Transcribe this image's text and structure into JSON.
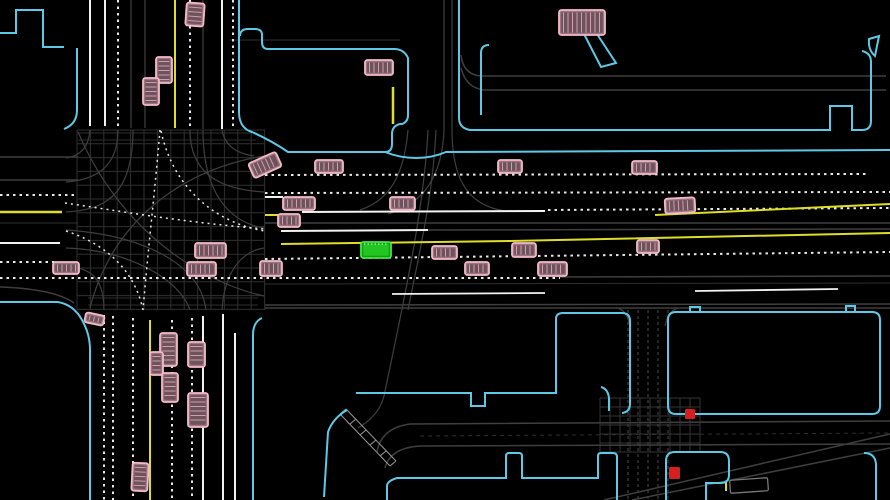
{
  "meta": {
    "width": 890,
    "height": 500,
    "background": "#000000",
    "view": "birds-eye-driving-scene"
  },
  "palette": {
    "curb": "#5ec9e6",
    "gray": "#3f3f3f",
    "dimgray": "#2e2e2e",
    "midgray": "#4a4a4a",
    "lightgray": "#9a9a9a",
    "white": "#f2f2f2",
    "dotted": "#e9e9e9",
    "yellow": "#dede2a",
    "vehicle_fill": "#9b7680",
    "vehicle_stroke": "#f4bac9",
    "vehicle_inner": "#6e525c",
    "vehicle_stripe": "#cf9fae",
    "ego_fill": "#149a14",
    "ego_stroke": "#41e841",
    "ego_inner": "#23c523",
    "ego_stripe": "#d8ffd8",
    "ghost": "#787878",
    "red_light": "#d81f1f"
  },
  "map": {
    "grids": [
      {
        "x0": 77,
        "x1": 265,
        "y0": 130,
        "y1": 310,
        "sx": 13.4,
        "sy": 13.8,
        "color": "#303030",
        "w": 1
      },
      {
        "x0": 600,
        "x1": 700,
        "y0": 398,
        "y1": 452,
        "sx": 10,
        "sy": 9,
        "color": "#343434",
        "w": 1
      }
    ],
    "paths": [
      {
        "d": "M0,157 L78,157",
        "color": "gray",
        "w": 1.5
      },
      {
        "d": "M0,180 L78,180",
        "color": "gray",
        "w": 1.5
      },
      {
        "d": "M0,223 L78,223",
        "color": "dimgray",
        "w": 1
      },
      {
        "d": "M230,40 L400,40",
        "color": "dimgray",
        "w": 1
      },
      {
        "d": "M265,223 L890,223",
        "color": "gray",
        "w": 1.5
      },
      {
        "d": "M428,230 L890,229",
        "color": "gray",
        "w": 1.5
      },
      {
        "d": "M560,277 L890,276",
        "color": "gray",
        "w": 1.5
      },
      {
        "d": "M265,284 L890,283",
        "color": "dimgray",
        "w": 1
      },
      {
        "d": "M265,305 L890,304",
        "color": "gray",
        "w": 1.5
      },
      {
        "d": "M265,308 L890,308",
        "color": "gray",
        "w": 1.5
      },
      {
        "d": "M461,55 Q463,74 480,76 L886,76",
        "color": "gray",
        "w": 1.5
      },
      {
        "d": "M461,68 Q466,88 484,90 L886,90",
        "color": "gray",
        "w": 1.5
      },
      {
        "d": "M444,0 L444,130",
        "color": "gray",
        "w": 1.2
      },
      {
        "d": "M452,0 L452,130",
        "color": "gray",
        "w": 1.2
      },
      {
        "d": "M131,0 L131,128",
        "color": "gray",
        "w": 1.2
      },
      {
        "d": "M145,0 L145,128",
        "color": "gray",
        "w": 1.2
      },
      {
        "d": "M203,0 L203,129",
        "color": "gray",
        "w": 1.2
      },
      {
        "d": "M444,130 C442,180 420,205 388,214",
        "color": "gray",
        "w": 1.2
      },
      {
        "d": "M452,130 C452,185 472,206 505,211",
        "color": "gray",
        "w": 1.2
      },
      {
        "d": "M436,130 C433,195 420,250 408,310",
        "color": "gray",
        "w": 1.2
      },
      {
        "d": "M428,130 C424,210 404,300 384,396 C380,412 368,422 358,428",
        "color": "gray",
        "w": 1.2
      },
      {
        "d": "M408,130 C404,175 390,200 360,210",
        "color": "gray",
        "w": 1.2
      },
      {
        "d": "M78,133 L256,133",
        "color": "dimgray",
        "w": 1
      },
      {
        "d": "M78,140 L256,140",
        "color": "dimgray",
        "w": 1
      },
      {
        "d": "M88,298 L258,298",
        "color": "dimgray",
        "w": 1
      },
      {
        "d": "M88,305 L258,305",
        "color": "dimgray",
        "w": 1
      },
      {
        "d": "M628,310 L628,500",
        "color": "gray",
        "w": 1.2,
        "dash": "3 3"
      },
      {
        "d": "M638,310 L638,500",
        "color": "gray",
        "w": 1.2,
        "dash": "3 3"
      },
      {
        "d": "M648,310 L648,500",
        "color": "gray",
        "w": 1.2,
        "dash": "3 3"
      },
      {
        "d": "M658,310 L658,500",
        "color": "gray",
        "w": 1.2,
        "dash": "3 3"
      },
      {
        "d": "M668,310 L668,500",
        "color": "gray",
        "w": 1.2,
        "dash": "3 3"
      },
      {
        "d": "M618,308 Q627,311 630,326",
        "color": "gray",
        "w": 1.2
      },
      {
        "d": "M678,308 Q668,311 665,326",
        "color": "gray",
        "w": 1.2
      },
      {
        "d": "M377,452 Q381,428 410,424 L890,421",
        "color": "gray",
        "w": 1.5
      },
      {
        "d": "M385,468 Q390,448 420,446 L890,444",
        "color": "gray",
        "w": 1.5
      },
      {
        "d": "M420,436 L890,433",
        "color": "dimgray",
        "w": 1,
        "dash": "4 4"
      },
      {
        "d": "M604,500 L890,434",
        "color": "gray",
        "w": 1.5
      },
      {
        "d": "M632,500 L890,448",
        "color": "gray",
        "w": 1.5
      },
      {
        "d": "M0,287 Q55,289 74,303",
        "color": "gray",
        "w": 1.5
      },
      {
        "d": "M118,130 C118,170 92,180 66,182",
        "color": "gray",
        "w": 1.2
      },
      {
        "d": "M133,130 C133,200 100,210 66,212",
        "color": "gray",
        "w": 1.2
      },
      {
        "d": "M190,130 C190,180 230,190 264,192",
        "color": "gray",
        "w": 1.2
      },
      {
        "d": "M203,130 C203,210 245,225 264,228",
        "color": "gray",
        "w": 1.2
      },
      {
        "d": "M66,248 C130,250 180,280 190,310",
        "color": "gray",
        "w": 1.2
      },
      {
        "d": "M66,230 C140,235 200,262 206,310",
        "color": "gray",
        "w": 1.2
      },
      {
        "d": "M222,310 C225,262 250,250 264,248",
        "color": "gray",
        "w": 1.2
      },
      {
        "d": "M104,310 C104,270 82,268 66,266",
        "color": "gray",
        "w": 1.2
      },
      {
        "d": "M78,132 C120,230 200,282 264,296",
        "color": "gray",
        "w": 1.2
      },
      {
        "d": "M264,156 C180,170 112,222 90,308",
        "color": "gray",
        "w": 1.2
      },
      {
        "d": "M90,130 Q88,155 66,158",
        "color": "gray",
        "w": 1.2
      },
      {
        "d": "M222,130 Q226,152 254,156",
        "color": "gray",
        "w": 1.2
      },
      {
        "d": "M90,0 L90,126",
        "color": "white",
        "w": 2
      },
      {
        "d": "M105,0 L105,126",
        "color": "white",
        "w": 2
      },
      {
        "d": "M222,0 L222,129",
        "color": "white",
        "w": 2
      },
      {
        "d": "M203,316 L203,500",
        "color": "white",
        "w": 2
      },
      {
        "d": "M223,314 L223,500",
        "color": "white",
        "w": 2
      },
      {
        "d": "M235,333 L235,500",
        "color": "white",
        "w": 2
      },
      {
        "d": "M302,212 L545,211",
        "color": "white",
        "w": 2
      },
      {
        "d": "M281,231 L428,230",
        "color": "white",
        "w": 2
      },
      {
        "d": "M0,243 L60,243",
        "color": "white",
        "w": 2
      },
      {
        "d": "M392,294 L545,293",
        "color": "white",
        "w": 1.8
      },
      {
        "d": "M695,291 L838,289",
        "color": "white",
        "w": 1.8
      },
      {
        "d": "M265,197 L283,197",
        "color": "white",
        "w": 2
      },
      {
        "d": "M118,0 L118,127",
        "color": "dotted",
        "w": 2,
        "dash": "2.5 4"
      },
      {
        "d": "M190,0 L190,128",
        "color": "dotted",
        "w": 2,
        "dash": "2.5 4"
      },
      {
        "d": "M233,0 L233,129",
        "color": "dotted",
        "w": 2,
        "dash": "2.5 4"
      },
      {
        "d": "M104,315 L104,500",
        "color": "dotted",
        "w": 2,
        "dash": "2.5 4"
      },
      {
        "d": "M113,316 L113,500",
        "color": "dotted",
        "w": 2,
        "dash": "2.5 4"
      },
      {
        "d": "M133,318 L133,500",
        "color": "dotted",
        "w": 2,
        "dash": "2.5 4"
      },
      {
        "d": "M172,320 L172,500",
        "color": "dotted",
        "w": 2,
        "dash": "2.5 4"
      },
      {
        "d": "M192,318 L192,500",
        "color": "dotted",
        "w": 2,
        "dash": "2.5 4"
      },
      {
        "d": "M0,195 L75,195",
        "color": "dotted",
        "w": 2,
        "dash": "2.5 4"
      },
      {
        "d": "M0,262 L58,262",
        "color": "dotted",
        "w": 2,
        "dash": "2.5 4"
      },
      {
        "d": "M0,278 L560,278",
        "color": "dotted",
        "w": 2,
        "dash": "2.5 4"
      },
      {
        "d": "M265,175 L868,174",
        "color": "dotted",
        "w": 2,
        "dash": "2.5 4"
      },
      {
        "d": "M265,193 L890,192",
        "color": "dotted",
        "w": 2,
        "dash": "2.5 4"
      },
      {
        "d": "M548,210 L890,208",
        "color": "dotted",
        "w": 2,
        "dash": "2.5 4"
      },
      {
        "d": "M265,259 L890,252",
        "color": "dotted",
        "w": 2,
        "dash": "2.5 4"
      },
      {
        "d": "M160,130 C155,190 148,250 143,310",
        "color": "dotted",
        "w": 1.5,
        "dash": "2 4"
      },
      {
        "d": "M65,203 C120,211 180,222 265,229",
        "color": "dotted",
        "w": 1.5,
        "dash": "2 4"
      },
      {
        "d": "M66,231 C112,246 136,276 143,310",
        "color": "dotted",
        "w": 1.5,
        "dash": "2 4"
      },
      {
        "d": "M161,131 C176,200 230,226 265,231",
        "color": "dotted",
        "w": 1.5,
        "dash": "2 4"
      },
      {
        "d": "M655,215 L890,204",
        "color": "yellow",
        "w": 2
      },
      {
        "d": "M281,244 L510,241 L890,233",
        "color": "yellow",
        "w": 2
      },
      {
        "d": "M0,212 L62,212",
        "color": "yellow",
        "w": 2.5
      },
      {
        "d": "M265,215 L282,215",
        "color": "yellow",
        "w": 2
      },
      {
        "d": "M175,0 L175,128",
        "color": "yellow",
        "w": 2
      },
      {
        "d": "M150,320 L150,500",
        "color": "yellow",
        "w": 2
      },
      {
        "d": "M393,87 L393,124",
        "color": "yellow",
        "w": 2.5
      },
      {
        "d": "M726,482 L726,491",
        "color": "yellow",
        "w": 2
      },
      {
        "d": "M346,409 L396,461 M340,414 L390,466 M346,409 L340,414 M356,419 L350,424 M366,430 L360,435 M376,440 L370,445 M386,451 L380,456 M396,461 L390,466",
        "color": "lightgray",
        "w": 1
      },
      {
        "d": "M0,33 L16,33 L16,10 L43,10 L43,47 L64,47",
        "color": "curb",
        "w": 2
      },
      {
        "d": "M77,48 L77,110 Q77,124 64,129",
        "color": "curb",
        "w": 2
      },
      {
        "d": "M239,0 L239,112 Q239,128 252,132 Q272,141 288,152 L385,152 Q392,152 392,144 L392,134 Q392,126 400,124 L402,124 Q408,122 408,115 L408,58 Q404,49 394,49 L268,49 Q262,49 262,42 L262,35 Q262,29 255,29 L248,29 Q240,29 240,36",
        "color": "curb",
        "w": 2
      },
      {
        "d": "M385,152 Q400,158 416,158 Q432,158 446,152 L890,150",
        "color": "curb",
        "w": 2
      },
      {
        "d": "M459,0 L459,118 Q459,128 470,130 L830,130 L830,106 L852,106 L852,130 L862,130 Q871,130 871,121 L871,62 Q871,53 862,51",
        "color": "curb",
        "w": 2
      },
      {
        "d": "M489,45 Q481,45 481,53 L481,115",
        "color": "curb",
        "w": 2
      },
      {
        "d": "M869,39 L879,36 L875,56 Q868,50 869,39 Z",
        "color": "curb",
        "w": 2
      },
      {
        "d": "M584,34 L597,34 L616,63 L601,67 Z",
        "color": "curb",
        "w": 2
      },
      {
        "d": "M0,302 L58,302 Q74,305 82,320 Q90,334 90,350 L90,500",
        "color": "curb",
        "w": 2
      },
      {
        "d": "M262,318 Q253,322 253,335 L253,500",
        "color": "curb",
        "w": 2
      },
      {
        "d": "M347,410 Q333,418 328,432 L324,497",
        "color": "curb",
        "w": 2
      },
      {
        "d": "M356,393 L471,393 L471,406 L485,406 L485,393 L556,393 L556,319 Q556,313 563,313 L622,313 Q630,313 630,321 L630,404 Q630,412 622,413",
        "color": "curb",
        "w": 2
      },
      {
        "d": "M601,387 Q608,389 609,398 L609,411",
        "color": "curb",
        "w": 2
      },
      {
        "d": "M676,312 L872,312 Q880,312 880,320 L880,406 Q880,414 872,414 L676,414 Q668,414 668,406 L668,320 Q668,312 676,312 Z",
        "color": "curb",
        "w": 2
      },
      {
        "d": "M690,312 L690,307 L700,307 L700,312 M846,312 L846,306 L855,306 L855,312",
        "color": "curb",
        "w": 2
      },
      {
        "d": "M666,500 L666,461 Q666,452 675,452 L720,452 Q729,452 729,461 L729,475 Q729,483 720,483 L706,483 L706,500",
        "color": "curb",
        "w": 2
      },
      {
        "d": "M864,453 Q875,453 876,464 L876,500",
        "color": "curb",
        "w": 2
      },
      {
        "d": "M387,500 L387,486 Q387,481 397,478 L506,478 L506,456 Q506,453 509,453 L519,453 Q522,453 522,456 L522,478 L598,478 L598,456 Q598,453 601,453 L613,453 Q617,453 617,457 L617,500",
        "color": "curb",
        "w": 2
      }
    ]
  },
  "agents": {
    "ego": {
      "x": 361,
      "y": 242,
      "w": 30,
      "h": 16,
      "rot": 0
    },
    "vehicles": [
      {
        "x": 186,
        "y": 3,
        "w": 18,
        "h": 23,
        "rot": 4
      },
      {
        "x": 156,
        "y": 57,
        "w": 16,
        "h": 26,
        "rot": 0
      },
      {
        "x": 143,
        "y": 78,
        "w": 16,
        "h": 27,
        "rot": 0
      },
      {
        "x": 365,
        "y": 60,
        "w": 28,
        "h": 15,
        "rot": 0
      },
      {
        "x": 559,
        "y": 10,
        "w": 46,
        "h": 25,
        "rot": 0
      },
      {
        "x": 250,
        "y": 157,
        "w": 30,
        "h": 16,
        "rot": -24
      },
      {
        "x": 315,
        "y": 160,
        "w": 28,
        "h": 13,
        "rot": 0
      },
      {
        "x": 498,
        "y": 160,
        "w": 24,
        "h": 13,
        "rot": 0
      },
      {
        "x": 632,
        "y": 161,
        "w": 25,
        "h": 13,
        "rot": 0
      },
      {
        "x": 283,
        "y": 197,
        "w": 32,
        "h": 13,
        "rot": 0
      },
      {
        "x": 390,
        "y": 197,
        "w": 25,
        "h": 13,
        "rot": 0
      },
      {
        "x": 665,
        "y": 198,
        "w": 30,
        "h": 15,
        "rot": -3
      },
      {
        "x": 278,
        "y": 214,
        "w": 22,
        "h": 13,
        "rot": 0
      },
      {
        "x": 195,
        "y": 243,
        "w": 31,
        "h": 15,
        "rot": 0
      },
      {
        "x": 187,
        "y": 262,
        "w": 29,
        "h": 14,
        "rot": 0
      },
      {
        "x": 53,
        "y": 262,
        "w": 26,
        "h": 12,
        "rot": 0
      },
      {
        "x": 260,
        "y": 261,
        "w": 22,
        "h": 15,
        "rot": 0
      },
      {
        "x": 538,
        "y": 262,
        "w": 29,
        "h": 14,
        "rot": 0
      },
      {
        "x": 465,
        "y": 262,
        "w": 24,
        "h": 13,
        "rot": 0
      },
      {
        "x": 432,
        "y": 246,
        "w": 25,
        "h": 13,
        "rot": 0
      },
      {
        "x": 512,
        "y": 243,
        "w": 24,
        "h": 14,
        "rot": 0
      },
      {
        "x": 637,
        "y": 240,
        "w": 22,
        "h": 13,
        "rot": 0
      },
      {
        "x": 85,
        "y": 314,
        "w": 19,
        "h": 10,
        "rot": 12
      },
      {
        "x": 160,
        "y": 333,
        "w": 17,
        "h": 33,
        "rot": 0
      },
      {
        "x": 150,
        "y": 352,
        "w": 13,
        "h": 23,
        "rot": 0
      },
      {
        "x": 188,
        "y": 342,
        "w": 17,
        "h": 25,
        "rot": 0
      },
      {
        "x": 162,
        "y": 373,
        "w": 16,
        "h": 29,
        "rot": 0
      },
      {
        "x": 188,
        "y": 393,
        "w": 20,
        "h": 34,
        "rot": 0
      },
      {
        "x": 132,
        "y": 463,
        "w": 16,
        "h": 28,
        "rot": 3
      }
    ],
    "ghost_vehicles": [
      {
        "x": 730,
        "y": 479,
        "w": 38,
        "h": 13,
        "rot": -4
      }
    ]
  },
  "signals": {
    "red_lights": [
      {
        "x": 685,
        "y": 409,
        "w": 10,
        "h": 10
      },
      {
        "x": 669,
        "y": 467,
        "w": 11,
        "h": 12
      }
    ]
  }
}
